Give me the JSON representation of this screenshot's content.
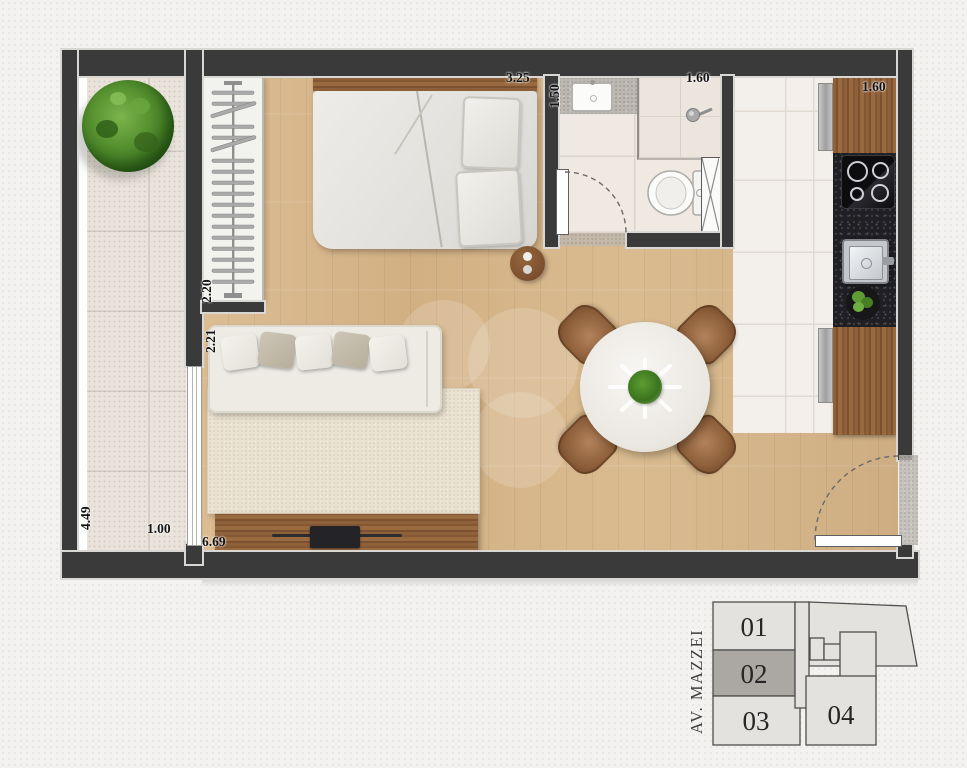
{
  "plan": {
    "dimensions": {
      "bedroom_width": "3.25",
      "bathroom_depth": "1.50",
      "bathroom_width": "1.60",
      "kitchen_width": "1.60",
      "closet_length": "2.20",
      "living_window_wall": "2.21",
      "balcony_length": "4.49",
      "balcony_width": "1.00",
      "living_length": "6.69"
    }
  },
  "keyplan": {
    "street_label": "AV. MAZZEI",
    "highlighted_unit": "02",
    "highlight_fill": "#aba7a2",
    "units": [
      {
        "label": "01",
        "highlighted": false
      },
      {
        "label": "02",
        "highlighted": true
      },
      {
        "label": "03",
        "highlighted": false
      },
      {
        "label": "04",
        "highlighted": false
      }
    ]
  },
  "colors": {
    "wall": "#3a3a3b",
    "wood_floor": "#d6b68c",
    "furniture_wood": "#8f613a",
    "granite_counter": "#202024",
    "keyplan_fill": "#e4e2df",
    "background": "#f3f2f0"
  }
}
